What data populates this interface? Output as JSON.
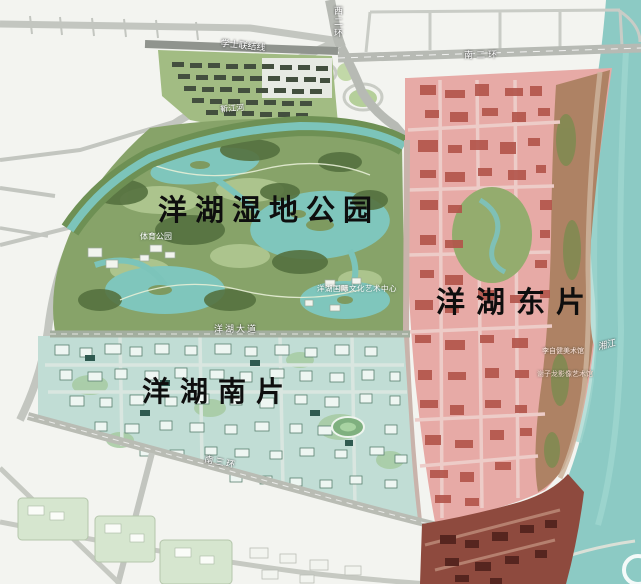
{
  "map": {
    "regions": {
      "park": {
        "label": "洋湖湿地公园",
        "color": "#87a369"
      },
      "east": {
        "label": "洋湖东片",
        "color": "#e7aaa6"
      },
      "south": {
        "label": "洋湖南片",
        "color": "#c1ddd5"
      }
    },
    "roads": {
      "xueshi_link": "学士联结线",
      "west_2nd_ring": "西二环",
      "south_2nd_ring": "南二环",
      "yanghu_avenue": "洋湖大道",
      "south_3rd_ring": "南三环"
    },
    "waters": {
      "xiang_river": "湘江",
      "jin_river": "靳江河",
      "color": "#8ccac4"
    },
    "pois": {
      "sports_park": "体育公园",
      "arts_center": "洋湖国际文化艺术中心",
      "li_zijian_museum": "李自健美术馆",
      "xie_zilong_museum": "谢子龙影像艺术馆"
    },
    "colors": {
      "lake_teal": "#7fc6bc",
      "road_gray": "#bcbfb9",
      "riverfront_brown": "#a97f5e",
      "dark_red_zone": "#8e4a3e"
    }
  }
}
